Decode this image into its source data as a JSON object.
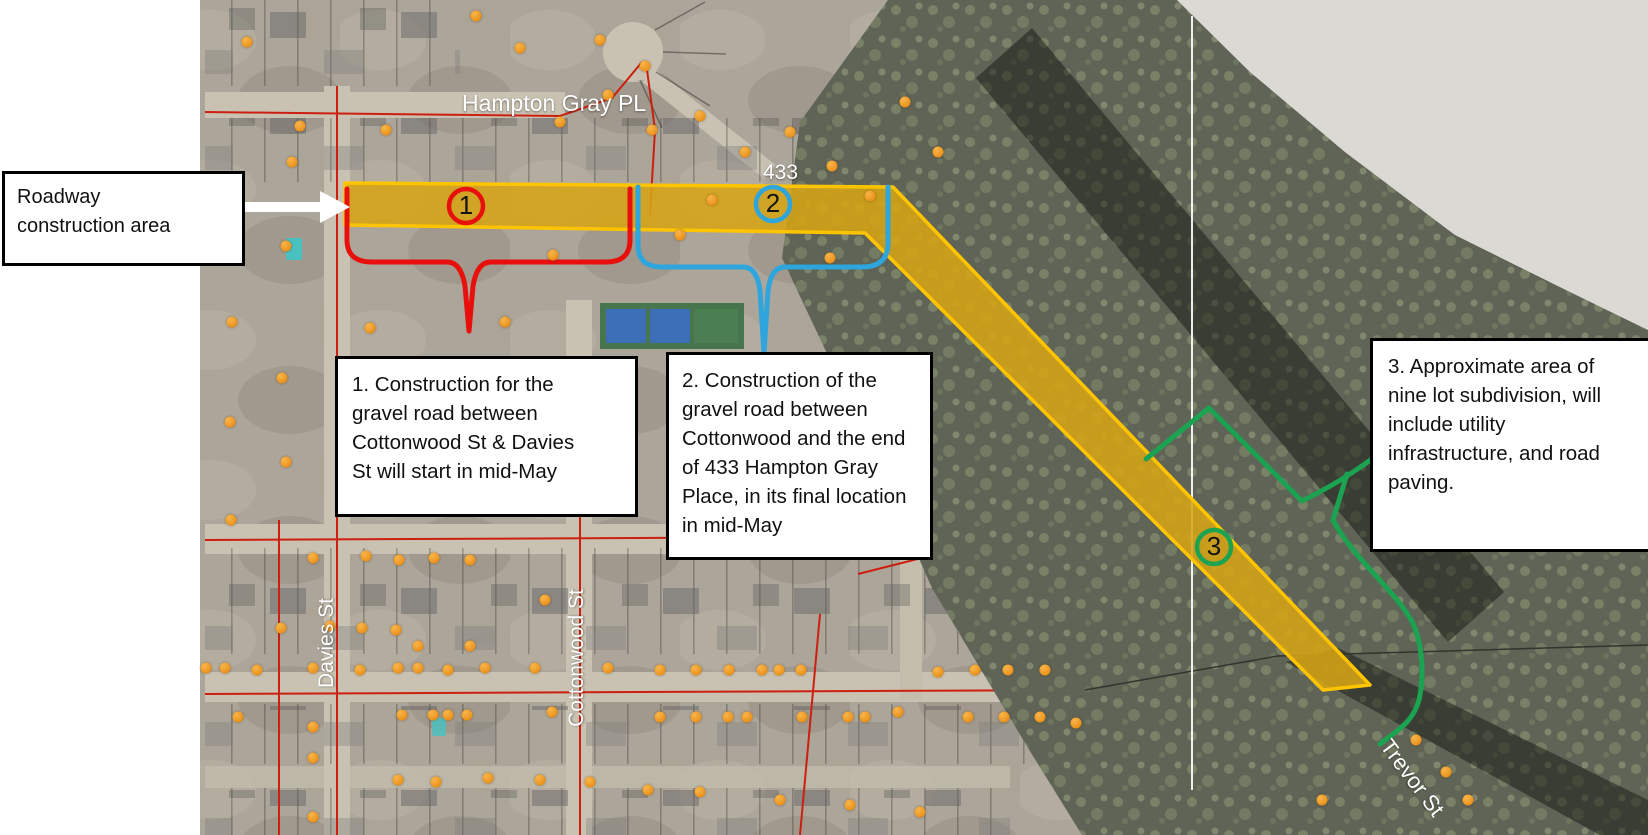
{
  "map": {
    "street_labels": {
      "hampton_gray_pl": "Hampton Gray PL",
      "davies_st": "Davies St",
      "cottonwood_st": "Cottonwood St",
      "trevor_st": "Trevor St",
      "address_433": "433"
    },
    "markers": {
      "m1": "1",
      "m2": "2",
      "m3": "3"
    },
    "callouts": {
      "roadway_label": "Roadway\nconstruction area",
      "note1": "1. Construction for the\ngravel road between\nCottonwood St & Davies\nSt will start in mid-May",
      "note2": "2. Construction of the\ngravel road between\nCottonwood and the end\nof 433 Hampton Gray\nPlace, in its final location\nin mid-May",
      "note3": "3. Approximate area of\nnine lot subdivision, will\ninclude utility\ninfrastructure, and road\npaving."
    },
    "legend_colors": {
      "construction_area_fill": "#D7A414",
      "construction_area_border": "#FFC400",
      "phase1_red": "#E8100C",
      "phase2_blue": "#2FA5DE",
      "phase3_green": "#1BA351",
      "address_point_orange": "#EC951F"
    },
    "address_points": [
      [
        247,
        42
      ],
      [
        300,
        126
      ],
      [
        292,
        162
      ],
      [
        386,
        130
      ],
      [
        476,
        16
      ],
      [
        520,
        48
      ],
      [
        560,
        122
      ],
      [
        600,
        40
      ],
      [
        608,
        95
      ],
      [
        645,
        66
      ],
      [
        652,
        130
      ],
      [
        700,
        116
      ],
      [
        712,
        200
      ],
      [
        745,
        152
      ],
      [
        790,
        132
      ],
      [
        832,
        166
      ],
      [
        870,
        196
      ],
      [
        905,
        102
      ],
      [
        938,
        152
      ],
      [
        830,
        258
      ],
      [
        680,
        235
      ],
      [
        553,
        255
      ],
      [
        370,
        328
      ],
      [
        505,
        322
      ],
      [
        237,
        206
      ],
      [
        286,
        246
      ],
      [
        232,
        322
      ],
      [
        282,
        378
      ],
      [
        230,
        422
      ],
      [
        286,
        462
      ],
      [
        231,
        520
      ],
      [
        313,
        558
      ],
      [
        366,
        556
      ],
      [
        399,
        560
      ],
      [
        434,
        558
      ],
      [
        470,
        560
      ],
      [
        545,
        600
      ],
      [
        281,
        628
      ],
      [
        330,
        626
      ],
      [
        362,
        628
      ],
      [
        396,
        630
      ],
      [
        418,
        646
      ],
      [
        470,
        646
      ],
      [
        206,
        668
      ],
      [
        225,
        668
      ],
      [
        257,
        670
      ],
      [
        313,
        668
      ],
      [
        360,
        670
      ],
      [
        398,
        668
      ],
      [
        418,
        668
      ],
      [
        448,
        670
      ],
      [
        485,
        668
      ],
      [
        535,
        668
      ],
      [
        608,
        668
      ],
      [
        660,
        670
      ],
      [
        696,
        670
      ],
      [
        729,
        670
      ],
      [
        762,
        670
      ],
      [
        779,
        670
      ],
      [
        801,
        670
      ],
      [
        938,
        672
      ],
      [
        975,
        670
      ],
      [
        1008,
        670
      ],
      [
        1045,
        670
      ],
      [
        238,
        717
      ],
      [
        313,
        727
      ],
      [
        402,
        715
      ],
      [
        433,
        715
      ],
      [
        448,
        715
      ],
      [
        467,
        715
      ],
      [
        552,
        712
      ],
      [
        660,
        717
      ],
      [
        696,
        717
      ],
      [
        728,
        717
      ],
      [
        747,
        717
      ],
      [
        802,
        717
      ],
      [
        848,
        717
      ],
      [
        865,
        717
      ],
      [
        898,
        712
      ],
      [
        968,
        717
      ],
      [
        1004,
        717
      ],
      [
        1040,
        717
      ],
      [
        1076,
        723
      ],
      [
        313,
        758
      ],
      [
        313,
        817
      ],
      [
        398,
        780
      ],
      [
        436,
        782
      ],
      [
        488,
        778
      ],
      [
        540,
        780
      ],
      [
        590,
        782
      ],
      [
        648,
        790
      ],
      [
        700,
        792
      ],
      [
        780,
        800
      ],
      [
        850,
        805
      ],
      [
        920,
        812
      ],
      [
        1322,
        800
      ],
      [
        1416,
        740
      ],
      [
        1446,
        772
      ],
      [
        1468,
        800
      ]
    ]
  }
}
